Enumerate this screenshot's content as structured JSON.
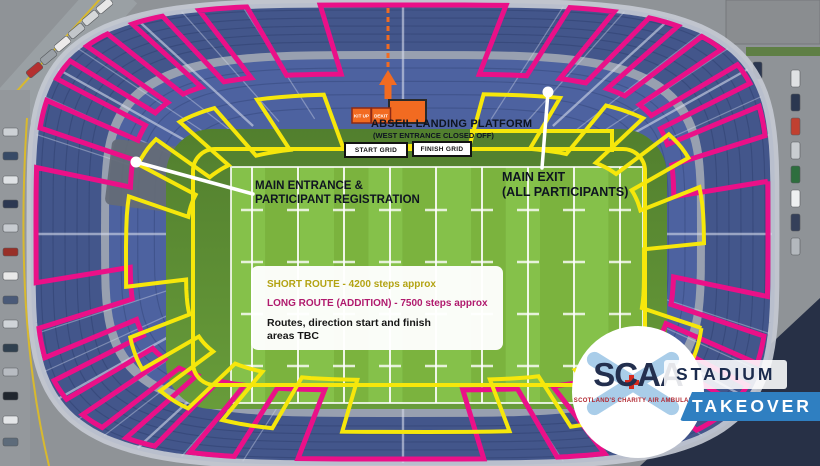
{
  "map": {
    "abseil_platform": {
      "title": "ABSEIL LANDING PLATFORM",
      "subtitle": "(WEST ENTRANCE CLOSED OFF)"
    },
    "tents": {
      "kit_up": "KIT UP",
      "dekit": "DEKIT"
    },
    "grids": {
      "start": "START GRID",
      "finish": "FINISH GRID"
    },
    "main_exit": {
      "line1": "MAIN EXIT",
      "line2": "(ALL PARTICIPANTS)"
    },
    "main_entrance": {
      "line1": "MAIN ENTRANCE &",
      "line2": "PARTICIPANT REGISTRATION"
    }
  },
  "legend": {
    "short_route": "SHORT ROUTE - 4200 steps approx",
    "long_route": "LONG ROUTE (ADDITION) - 7500 steps approx",
    "note_line1": "Routes, direction start and finish",
    "note_line2": "areas TBC"
  },
  "logo": {
    "acronym": "SCAA",
    "tagline": "SCOTLAND'S CHARITY AIR AMBULANCE",
    "badge_top": "STADIUM",
    "badge_bottom": "TAKEOVER"
  },
  "colors": {
    "short_route_line": "#f6e70b",
    "long_route_line": "#ea1088",
    "platform_orange": "#f26b21",
    "takeover_blue": "#2f7fc1",
    "logo_navy": "#232f4e"
  }
}
